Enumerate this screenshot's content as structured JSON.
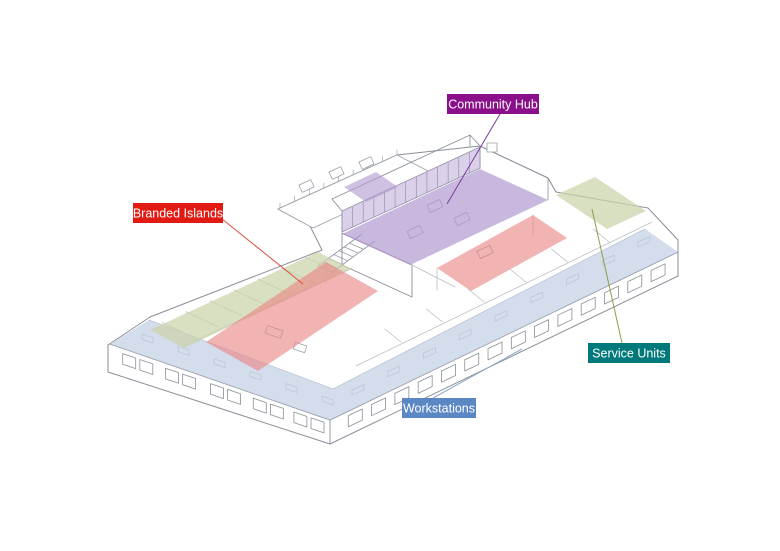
{
  "diagram": {
    "title": "Isometric office floor plan with zone overlays",
    "background": "#ffffff",
    "line_color": "#8a8f98",
    "light_line_color": "#b9bec6",
    "furniture_line_color": "#9aa1a9"
  },
  "zones": [
    {
      "id": "community-hub",
      "label": "Community Hub",
      "label_bg": "#8B0E8B",
      "label_text": "#FFFFFF",
      "fill": "#AE97CE",
      "leader_color": "#7A3BA3"
    },
    {
      "id": "branded-islands",
      "label": "Branded Islands",
      "label_bg": "#E11B14",
      "label_text": "#FFFFFF",
      "fill": "#EA8484",
      "leader_color": "#DC4B41"
    },
    {
      "id": "service-units",
      "label": "Service Units",
      "label_bg": "#00797B",
      "label_text": "#FFFFFF",
      "fill": "#CBD2A9",
      "leader_color": "#8F9B4D"
    },
    {
      "id": "workstations",
      "label": "Workstations",
      "label_bg": "#5B87C5",
      "label_text": "#FFFFFF",
      "fill": "#C4D0E4",
      "leader_color": "#8FA8C8"
    }
  ]
}
